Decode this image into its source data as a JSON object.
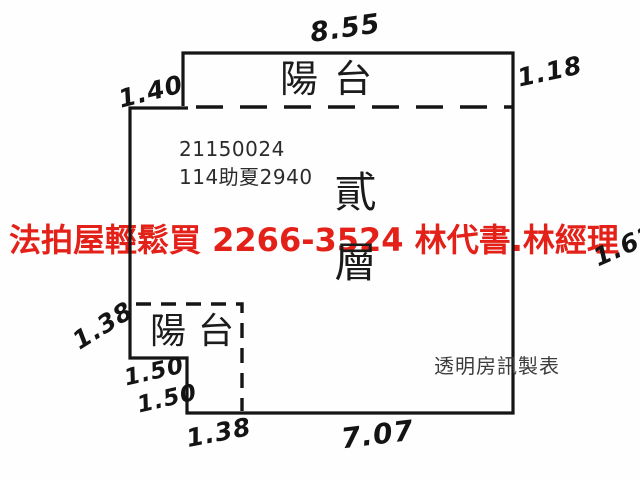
{
  "floorplan": {
    "type": "apartment-floor-plan",
    "balcony_top_label": "陽台",
    "balcony_bottom_label": "陽台",
    "floor_label": "貳層",
    "case_number_line1": "21150024",
    "case_number_line2": "114助夏2940",
    "maker_label": "透明房訊製表",
    "measurements": {
      "top": "8.55",
      "top_left": "1.40",
      "top_right": "1.18",
      "right": "1.62",
      "left_lower": "1.38",
      "step_upper": "1.50",
      "step_lower": "1.50",
      "bottom_left": "1.38",
      "bottom": "7.07"
    },
    "watermark": {
      "text": "法拍屋輕鬆買  2266-3524  林代書.林經理",
      "color": "#e32119"
    },
    "colors": {
      "wall_line": "#151515",
      "background": "#fefefe"
    }
  }
}
